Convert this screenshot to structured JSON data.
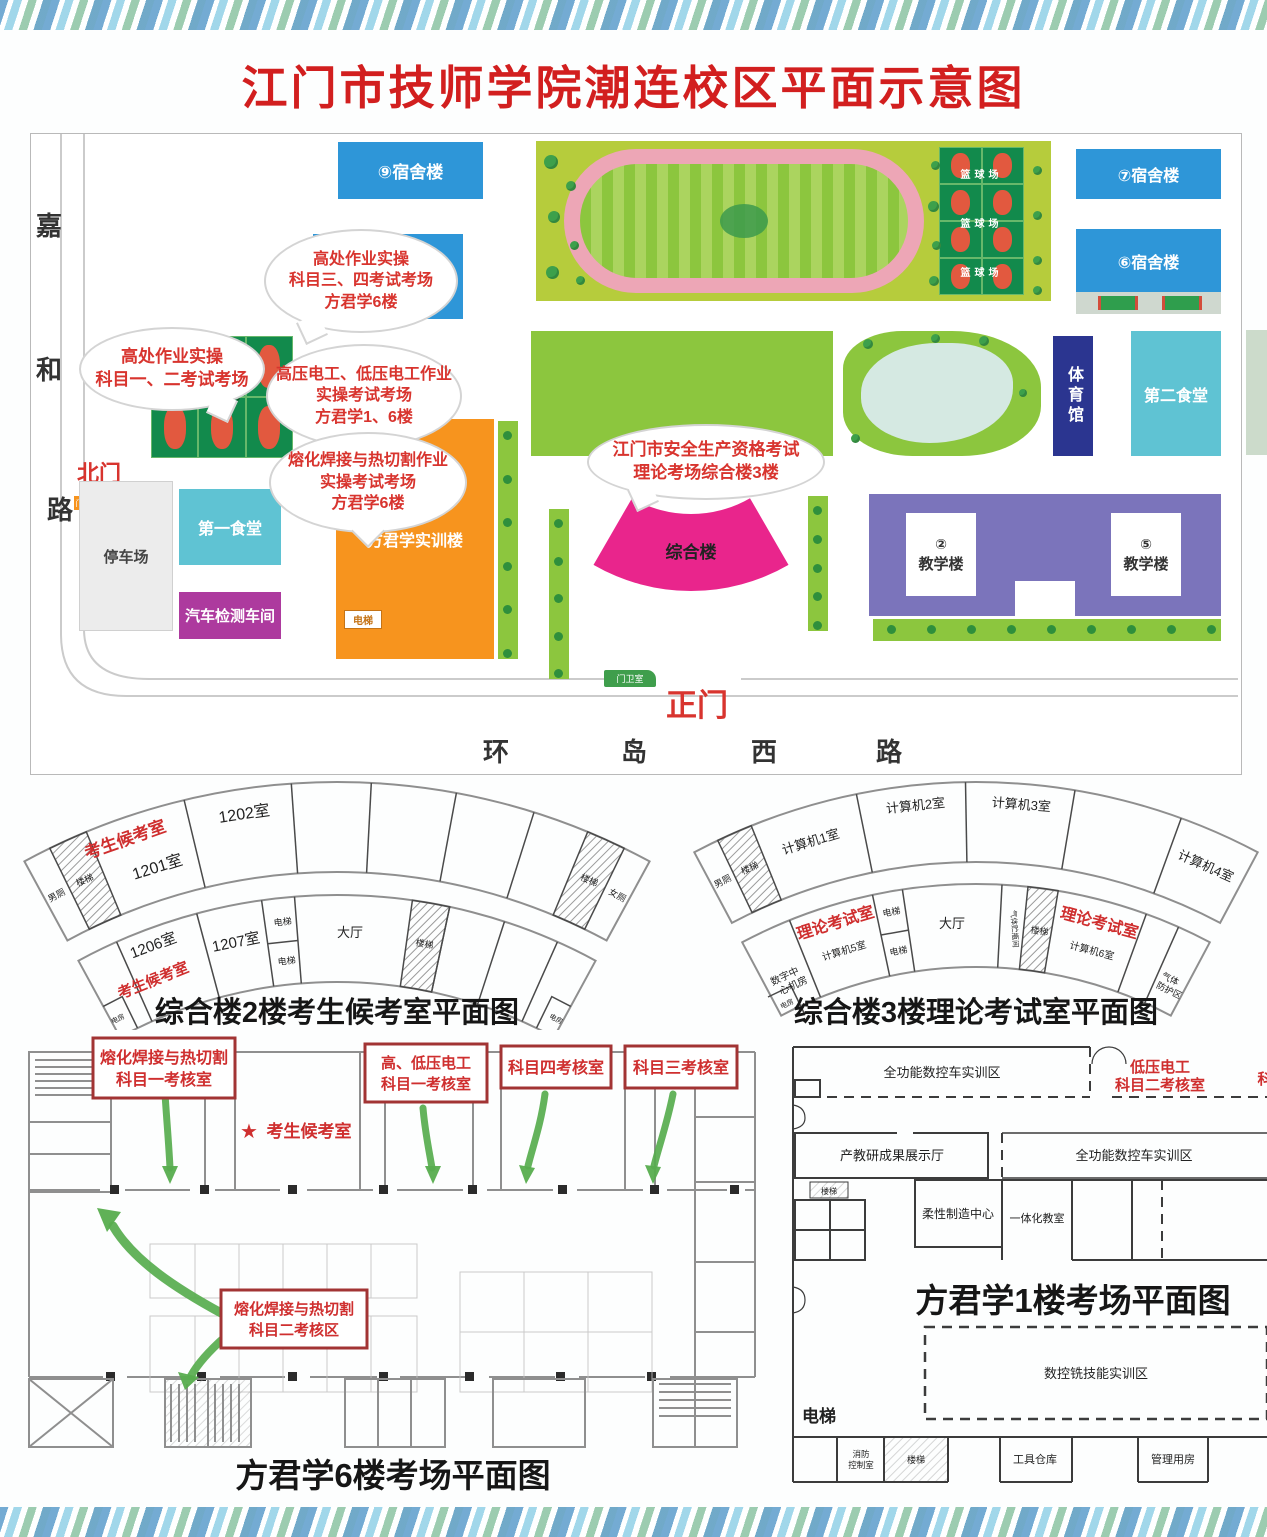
{
  "title": "江门市技师学院潮连校区平面示意图",
  "map": {
    "roads": {
      "left": [
        "嘉",
        "和",
        "路"
      ],
      "ring": [
        "环",
        "岛",
        "西",
        "路"
      ],
      "north_gate": "北门",
      "main_gate": "正门",
      "guard1": "门卫室",
      "guard2": "门卫室"
    },
    "bld": {
      "dorm9": "⑨宿舍楼",
      "dorm7": "⑦宿舍楼",
      "dorm6": "⑥宿舍楼",
      "bball": "篮球场",
      "gym": "体育馆",
      "canteen2": "第二食堂",
      "canteen1": "第一食堂",
      "parking": "停车场",
      "auto": "汽车检测车间",
      "fjx": "方君学实训楼",
      "lift": "电梯",
      "complex": "综合楼",
      "t2num": "②",
      "t5num": "⑤",
      "teach": "教学楼"
    },
    "bubbles": [
      {
        "lines": [
          "高处作业实操",
          "科目三、四考试考场",
          "方君学6楼"
        ]
      },
      {
        "lines": [
          "高处作业实操",
          "科目一、二考试考场"
        ]
      },
      {
        "lines": [
          "高压电工、低压电工作业",
          "实操考试考场",
          "方君学1、6楼"
        ]
      },
      {
        "lines": [
          "熔化焊接与热切割作业",
          "实操考试考场",
          "方君学6楼"
        ]
      },
      {
        "lines": [
          "江门市安全生产资格考试",
          "理论考场综合楼3楼"
        ]
      }
    ]
  },
  "fan2": {
    "caption": "综合楼2楼考生候考室平面图",
    "wait1": "考生候考室",
    "wait2": "考生候考室",
    "r1201": "1201室",
    "r1202": "1202室",
    "r1206": "1206室",
    "r1207": "1207室",
    "lift": "电梯",
    "hall": "大厅",
    "stair": "楼梯",
    "male": "男厕",
    "female": "女厕",
    "power": "电房"
  },
  "fan3": {
    "caption": "综合楼3楼理论考试室平面图",
    "pc1": "计算机1室",
    "pc2": "计算机2室",
    "pc3": "计算机3室",
    "pc4": "计算机4室",
    "pc5": "计算机5室",
    "pc6": "计算机6室",
    "theory": "理论考试室",
    "lift": "电梯",
    "hall": "大厅",
    "stair": "楼梯",
    "male": "男厕",
    "power": "电房",
    "gas": "气体贮瓶间",
    "digital1": "数字中",
    "digital2": "心机房",
    "prot1": "气体",
    "prot2": "防护区"
  },
  "plan6": {
    "caption": "方君学6楼考场平面图",
    "box1a": "熔化焊接与热切割",
    "box1b": "科目一考核室",
    "box2a": "高、低压电工",
    "box2b": "科目一考核室",
    "box3": "科目四考核室",
    "box4": "科目三考核室",
    "box5a": "熔化焊接与热切割",
    "box5b": "科目二考核区",
    "star": "★",
    "wait": "考生候考室"
  },
  "plan1": {
    "caption": "方君学1楼考场平面图",
    "cnc1": "全功能数控车实训区",
    "cnc2": "全功能数控车实训区",
    "lv1": "低压电工",
    "lv2": "科目二考核室",
    "lvpart": "科",
    "exhibit": "产教研成果展示厅",
    "flex": "柔性制造中心",
    "integr": "一体化教室",
    "mill": "数控铣技能实训区",
    "lift": "电梯",
    "fire1": "消防",
    "fire2": "控制室",
    "stair": "楼梯",
    "tool": "工具仓库",
    "mgmt": "管理用房"
  }
}
